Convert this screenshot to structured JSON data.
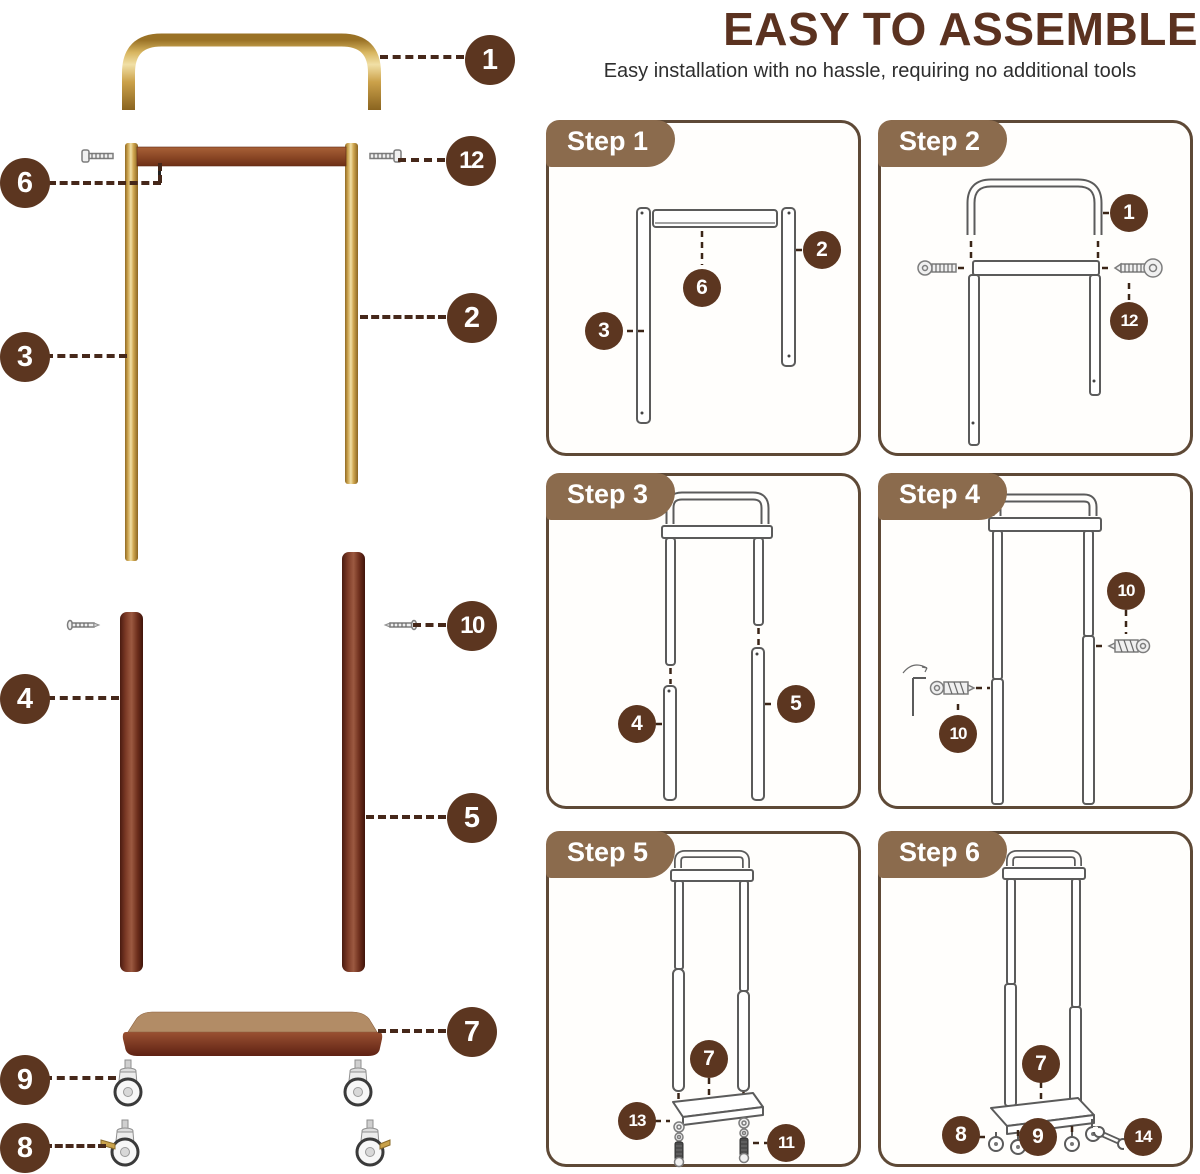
{
  "header": {
    "title": "EASY TO ASSEMBLE",
    "subtitle": "Easy installation with no hassle, requiring no additional tools"
  },
  "exploded": {
    "callouts": [
      "1",
      "6",
      "12",
      "2",
      "3",
      "10",
      "4",
      "5",
      "7",
      "9",
      "8"
    ]
  },
  "steps": [
    {
      "label": "Step 1",
      "callouts": [
        "6",
        "3",
        "2"
      ]
    },
    {
      "label": "Step 2",
      "callouts": [
        "1",
        "12"
      ]
    },
    {
      "label": "Step 3",
      "callouts": [
        "4",
        "5"
      ]
    },
    {
      "label": "Step 4",
      "callouts": [
        "10",
        "10"
      ]
    },
    {
      "label": "Step 5",
      "callouts": [
        "7",
        "13",
        "11"
      ]
    },
    {
      "label": "Step 6",
      "callouts": [
        "7",
        "8",
        "9",
        "14"
      ]
    }
  ],
  "colors": {
    "title_brown": "#5b3220",
    "callout_brown": "#5c3620",
    "badge_brown": "#8b6b4d",
    "panel_border": "#5e4936",
    "dash_brown": "#46281a",
    "gold": "#cda24c",
    "walnut": "#7c3a26",
    "plate_tan": "#b28c66"
  },
  "icons": {
    "screw": "screw-icon",
    "bolt": "bolt-icon",
    "caster": "caster-icon",
    "locking_caster": "locking-caster-icon",
    "wrench": "wrench-icon",
    "allen_key": "allen-key-icon"
  }
}
